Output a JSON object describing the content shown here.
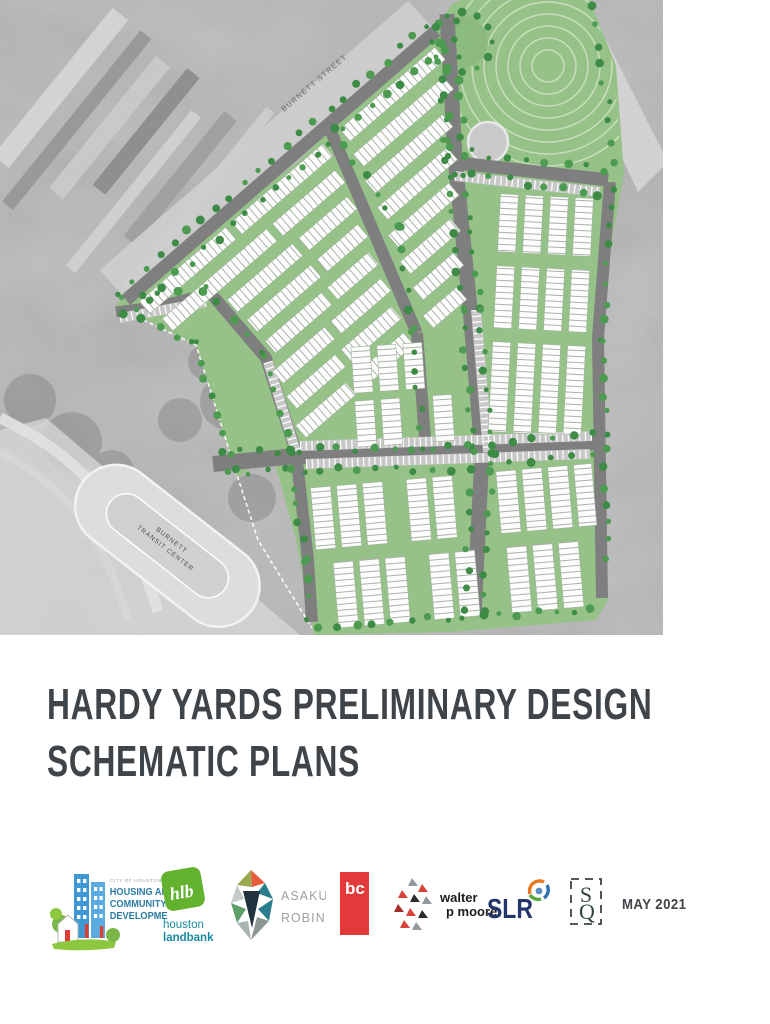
{
  "document": {
    "type": "report-cover-page"
  },
  "cover_image": {
    "description": "aerial photo with overlaid site development schematic plan",
    "street_labels": {
      "burnett_street": "BURNETT STREET",
      "elysian_street": "ELYSIAN STREET",
      "transit_center_line1": "BURNETT",
      "transit_center_line2": "TRANSIT CENTER"
    },
    "colors": {
      "aerial_gray": "#b7b7b7",
      "site_green": "#95c287",
      "street_gray": "#7d7d7d",
      "tree_green": "#4a9a4e",
      "block_white": "#ffffff",
      "park_arc": "#c9dfbd"
    }
  },
  "title": {
    "line1": "HARDY YARDS PRELIMINARY DESIGN",
    "line2": "SCHEMATIC PLANS",
    "color": "#3f4449"
  },
  "footer": {
    "date": "MAY 2021",
    "logos": [
      {
        "id": "city-of-houston-hcd",
        "eyebrow": "CITY OF HOUSTON",
        "lines": [
          "HOUSING AND",
          "COMMUNITY",
          "DEVELOPMENT"
        ]
      },
      {
        "id": "houston-landbank",
        "monogram": "hlb",
        "lines": [
          "houston",
          "landbank"
        ]
      },
      {
        "id": "asakura-robinson",
        "lines": [
          "ASAKURA",
          "ROBINSON"
        ]
      },
      {
        "id": "bc",
        "monogram": "bc"
      },
      {
        "id": "walter-p-moore",
        "lines": [
          "walter",
          "p moore"
        ]
      },
      {
        "id": "slr",
        "text": "SLR"
      },
      {
        "id": "sq-studio",
        "letters": [
          "S",
          "Q"
        ]
      }
    ]
  }
}
